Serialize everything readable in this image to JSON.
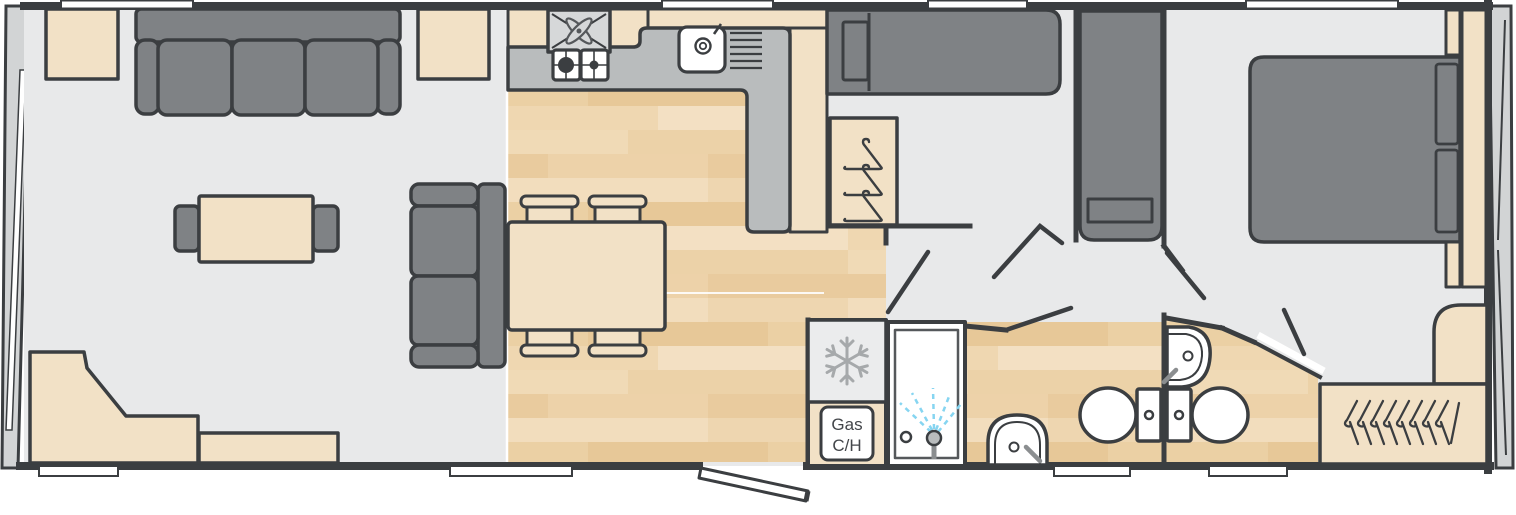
{
  "floorplan": {
    "boiler_label": {
      "line1": "Gas",
      "line2": "C/H"
    },
    "colors": {
      "wall": "#3b3e41",
      "hard_floor": "#e8e9ea",
      "wood_base": "#eed5ae",
      "wood_band_light": "#f3e0c3",
      "wood_band_dark": "#e8c998",
      "furniture_tan": "#f2e1c6",
      "furniture_gray": "#7f8285",
      "counter_gray": "#b9bcbd",
      "appliance_gray": "#d6d8d9",
      "fridge_panel": "#ebeced",
      "snowflake_gray": "#a6a9ab",
      "spray_blue": "#86d5f1",
      "window_white": "#ffffff"
    },
    "icons": [
      "extractor-fan-icon",
      "hob-burner-icon",
      "sink-drainer-icon",
      "clothes-hanger-icon",
      "snowflake-icon",
      "shower-head-icon",
      "toilet-icon",
      "basin-icon"
    ]
  }
}
